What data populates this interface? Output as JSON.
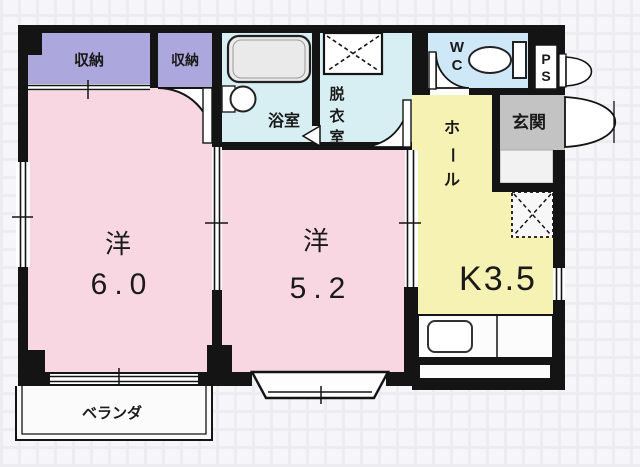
{
  "plan": {
    "type": "floor-plan",
    "rooms": {
      "storage_left": {
        "label": "収納"
      },
      "storage_right": {
        "label": "収納"
      },
      "bathroom": {
        "label": "浴室"
      },
      "dressing": {
        "chars": [
          "脱",
          "衣",
          "室"
        ]
      },
      "wc": {
        "chars": [
          "W",
          "C"
        ]
      },
      "ps": {
        "chars": [
          "P",
          "S"
        ]
      },
      "genkan": {
        "label": "玄関"
      },
      "hall": {
        "chars": [
          "ホ",
          "ー",
          "ル"
        ]
      },
      "kitchen": {
        "label": "K3.5"
      },
      "western_room_1": {
        "label": "洋",
        "size": "6.0"
      },
      "western_room_2": {
        "label": "洋",
        "size": "5.2"
      },
      "veranda": {
        "label": "ベランダ"
      }
    },
    "colors": {
      "wall": "#141414",
      "room_pink": "#f8d7e3",
      "storage_purple": "#aca7dd",
      "bath_cyan": "#d7eef3",
      "wc_blue": "#cfe8f8",
      "hall_yellow": "#f6f2b3",
      "genkan_gray": "#c3c3c3",
      "fixture_gray": "#eaeaea",
      "floor_white": "#fcfcfc"
    }
  }
}
